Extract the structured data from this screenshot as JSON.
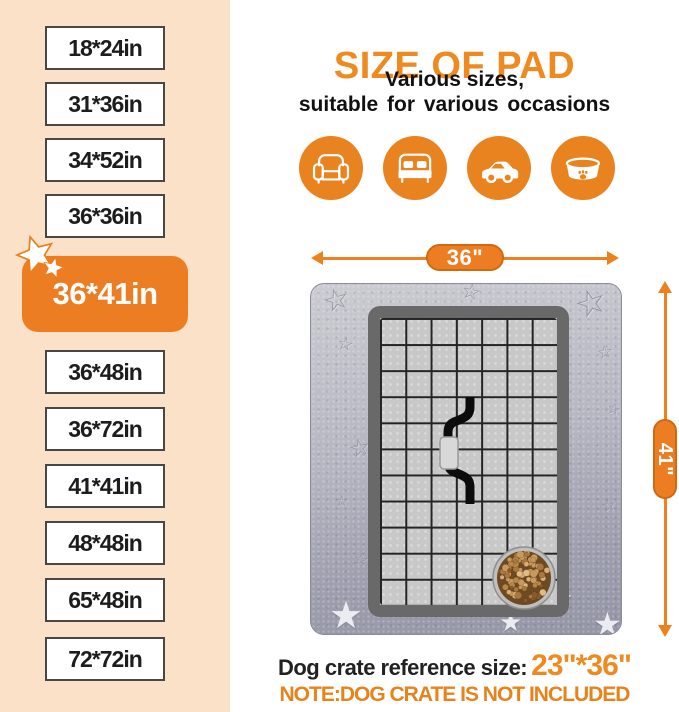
{
  "colors": {
    "accent_orange": "#ed811e",
    "badge_orange": "#ed7d23",
    "panel_peach": "#fbe1c7",
    "text_dark": "#1d1d1d",
    "pad_gray": "#a6a7b5",
    "crate_border_gray": "#696969",
    "crate_floor_gray": "#c8c8c8"
  },
  "header": {
    "title": "SIZE OF PAD",
    "subtitle_line1": "Various sizes,",
    "subtitle_line2": "suitable for various occasions"
  },
  "size_panel": {
    "top_sizes": [
      "18*24in",
      "31*36in",
      "34*52in",
      "36*36in"
    ],
    "highlighted_size": "36*41in",
    "bottom_sizes": [
      "36*48in",
      "36*72in",
      "41*41in",
      "48*48in",
      "65*48in",
      "72*72in"
    ]
  },
  "occasions": {
    "icons": [
      {
        "name": "sofa-icon"
      },
      {
        "name": "bed-icon"
      },
      {
        "name": "car-icon"
      },
      {
        "name": "pet-bed-icon"
      }
    ]
  },
  "pad_diagram": {
    "width_label": "36\"",
    "height_label": "41\""
  },
  "footer": {
    "reference_label": "Dog crate reference size:",
    "reference_size": "23\"*36\"",
    "note": "NOTE:DOG CRATE IS NOT INCLUDED"
  }
}
